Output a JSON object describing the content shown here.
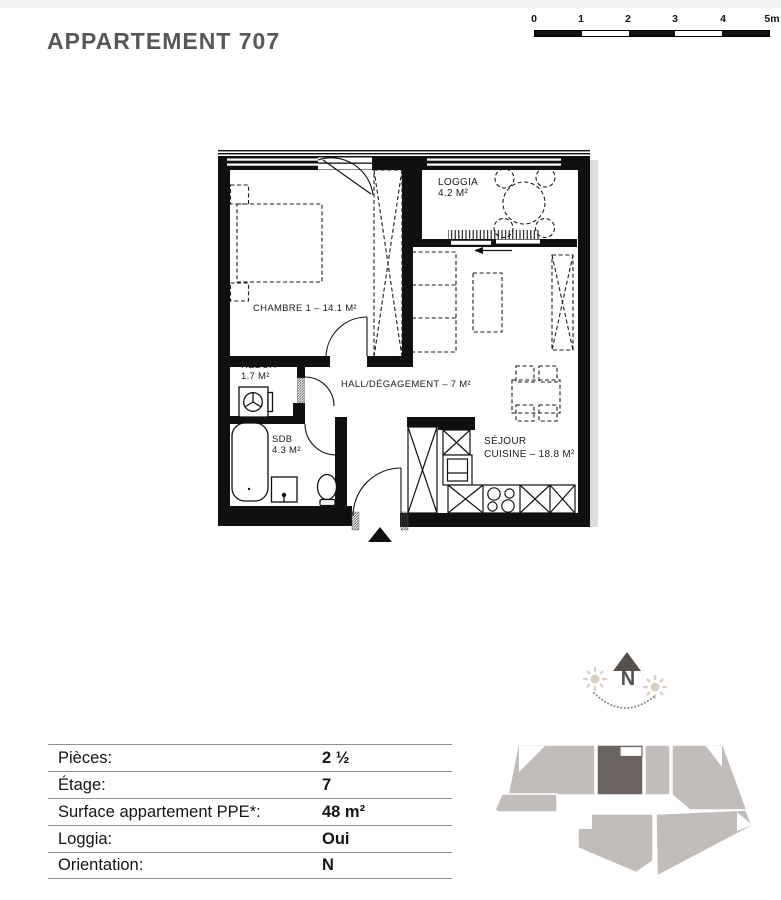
{
  "header": {
    "title": "APPARTEMENT 707"
  },
  "scale_bar": {
    "tick_labels": [
      "0",
      "1",
      "2",
      "3",
      "4",
      "5m"
    ]
  },
  "floor_plan": {
    "rooms": {
      "chambre": {
        "label": "CHAMBRE 1 – 14.1 M²"
      },
      "loggia": {
        "name": "LOGGIA",
        "area": "4.2 M²"
      },
      "reduit": {
        "name": "REDUIT",
        "area": "1.7 M²"
      },
      "sdb": {
        "name": "SDB",
        "area": "4.3 M²"
      },
      "hall": {
        "label": "HALL/DÉGAGEMENT – 7 M²"
      },
      "sejour": {
        "name": "SÉJOUR",
        "area_line": "CUISINE – 18.8 M²"
      }
    }
  },
  "compass": {
    "north_label": "N"
  },
  "details_table": {
    "rows": [
      {
        "label": "Pièces:",
        "value": "2 ½"
      },
      {
        "label": "Étage:",
        "value": "7"
      },
      {
        "label": "Surface appartement PPE*:",
        "value": "48 m²"
      },
      {
        "label": "Loggia:",
        "value": "Oui"
      },
      {
        "label": "Orientation:",
        "value": "N"
      }
    ]
  },
  "colors": {
    "wall": "#101010",
    "title_gray": "#575757",
    "footprint_unit": "#c2bdba",
    "footprint_highlight": "#6b6460",
    "compass_dark": "#55504c",
    "sun": "#d8cec1"
  }
}
